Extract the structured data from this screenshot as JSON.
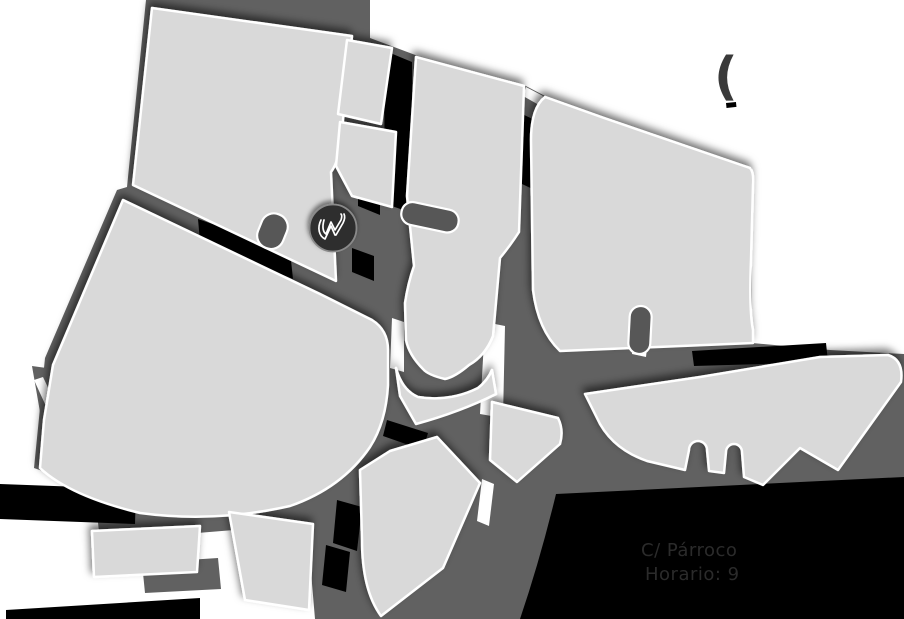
{
  "page": {
    "background_color": "#ffffff"
  },
  "map": {
    "type": "stylized-street-map",
    "blocks_color": "#d9d9d9",
    "street_color": "#616161",
    "shadow_color": "#000000",
    "outline_color": "#ffffff",
    "marker": {
      "letter": "W",
      "fill": "#2e2e2e",
      "ring": "#8a8a8a",
      "glyph_color": "#ffffff"
    },
    "labels": {
      "partial_bracket": "(",
      "address": "C/ Párroco",
      "hours": "Horario: 9",
      "text_color": "#2b2b2b",
      "bracket_color": "#3a3a3a"
    }
  }
}
